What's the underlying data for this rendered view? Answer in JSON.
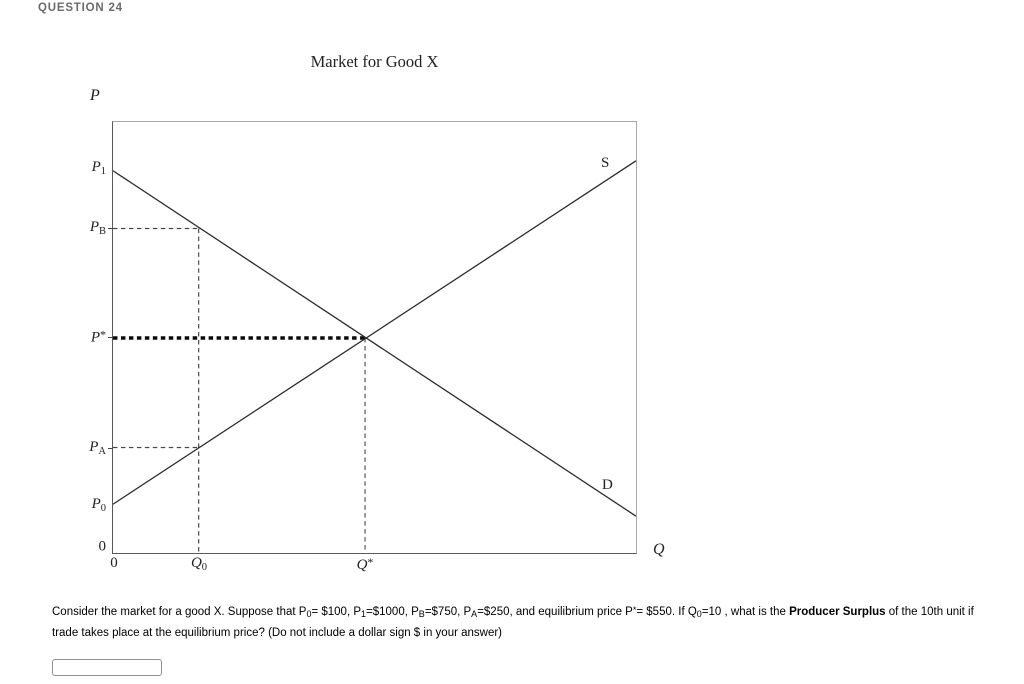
{
  "page": {
    "question_header": "QUESTION 24"
  },
  "figure": {
    "title": "Market for Good X",
    "y_axis_label": "P",
    "x_axis_label": "Q",
    "supply_label": "S",
    "demand_label": "D",
    "origin_y_label": "0",
    "origin_x_label": "0",
    "ticks": {
      "p1": {
        "main": "P",
        "sub": "1"
      },
      "pb": {
        "main": "P",
        "sub": "B"
      },
      "pstar": {
        "main": "P",
        "sup": "*"
      },
      "pa": {
        "main": "P",
        "sub": "A"
      },
      "p0": {
        "main": "P",
        "sub": "0"
      },
      "q0": {
        "main": "Q",
        "sub": "0"
      },
      "qstar": {
        "main": "Q",
        "sup": "*"
      }
    }
  },
  "chart_data": {
    "type": "line",
    "title": "Market for Good X",
    "xlabel": "Q",
    "ylabel": "P",
    "x_tick_labels": [
      "0",
      "Q0",
      "Q*"
    ],
    "y_tick_labels": [
      "0",
      "P0",
      "PA",
      "P*",
      "PB",
      "P1"
    ],
    "series": [
      {
        "name": "S",
        "description": "supply curve, upward sloping",
        "points": [
          {
            "x": 0,
            "y": 100
          },
          {
            "x": 10,
            "y": 250
          },
          {
            "x": "Q*",
            "y": 550
          }
        ]
      },
      {
        "name": "D",
        "description": "demand curve, downward sloping",
        "points": [
          {
            "x": 0,
            "y": 1000
          },
          {
            "x": 10,
            "y": 750
          },
          {
            "x": "Q*",
            "y": 550
          }
        ]
      }
    ],
    "known_values": {
      "P0": 100,
      "P1": 1000,
      "PB": 750,
      "PA": 250,
      "Pstar": 550,
      "Q0": 10
    },
    "annotations": [
      "dashed vertical guide at Q0 up to demand curve",
      "dashed horizontal guide from PB to demand curve at Q0",
      "dashed horizontal guide from PA to supply curve at Q0",
      "bold dotted horizontal guide from P* to equilibrium",
      "dashed vertical guide from equilibrium down to Q*"
    ],
    "legend_position": "curve-end labels S and D",
    "grid": false
  },
  "question": {
    "segments": [
      {
        "t": "Consider the market for a good X. Suppose that P"
      },
      {
        "t": "0"
      },
      {
        "t": "= $100, P"
      },
      {
        "t": "1"
      },
      {
        "t": "=$1000, P"
      },
      {
        "t": "B"
      },
      {
        "t": "=$750, P"
      },
      {
        "t": "A"
      },
      {
        "t": "=$250, and equilibrium price P"
      },
      {
        "t": "*"
      },
      {
        "t": "= $550. If Q"
      },
      {
        "t": "0"
      },
      {
        "t": "=10 , what is the "
      },
      {
        "t": "Producer Surplus"
      },
      {
        "t": " of the 10th unit if trade takes place at the equilibrium price? (Do not include a dollar sign $ in your answer)"
      }
    ]
  },
  "answer_input": {
    "value": ""
  }
}
